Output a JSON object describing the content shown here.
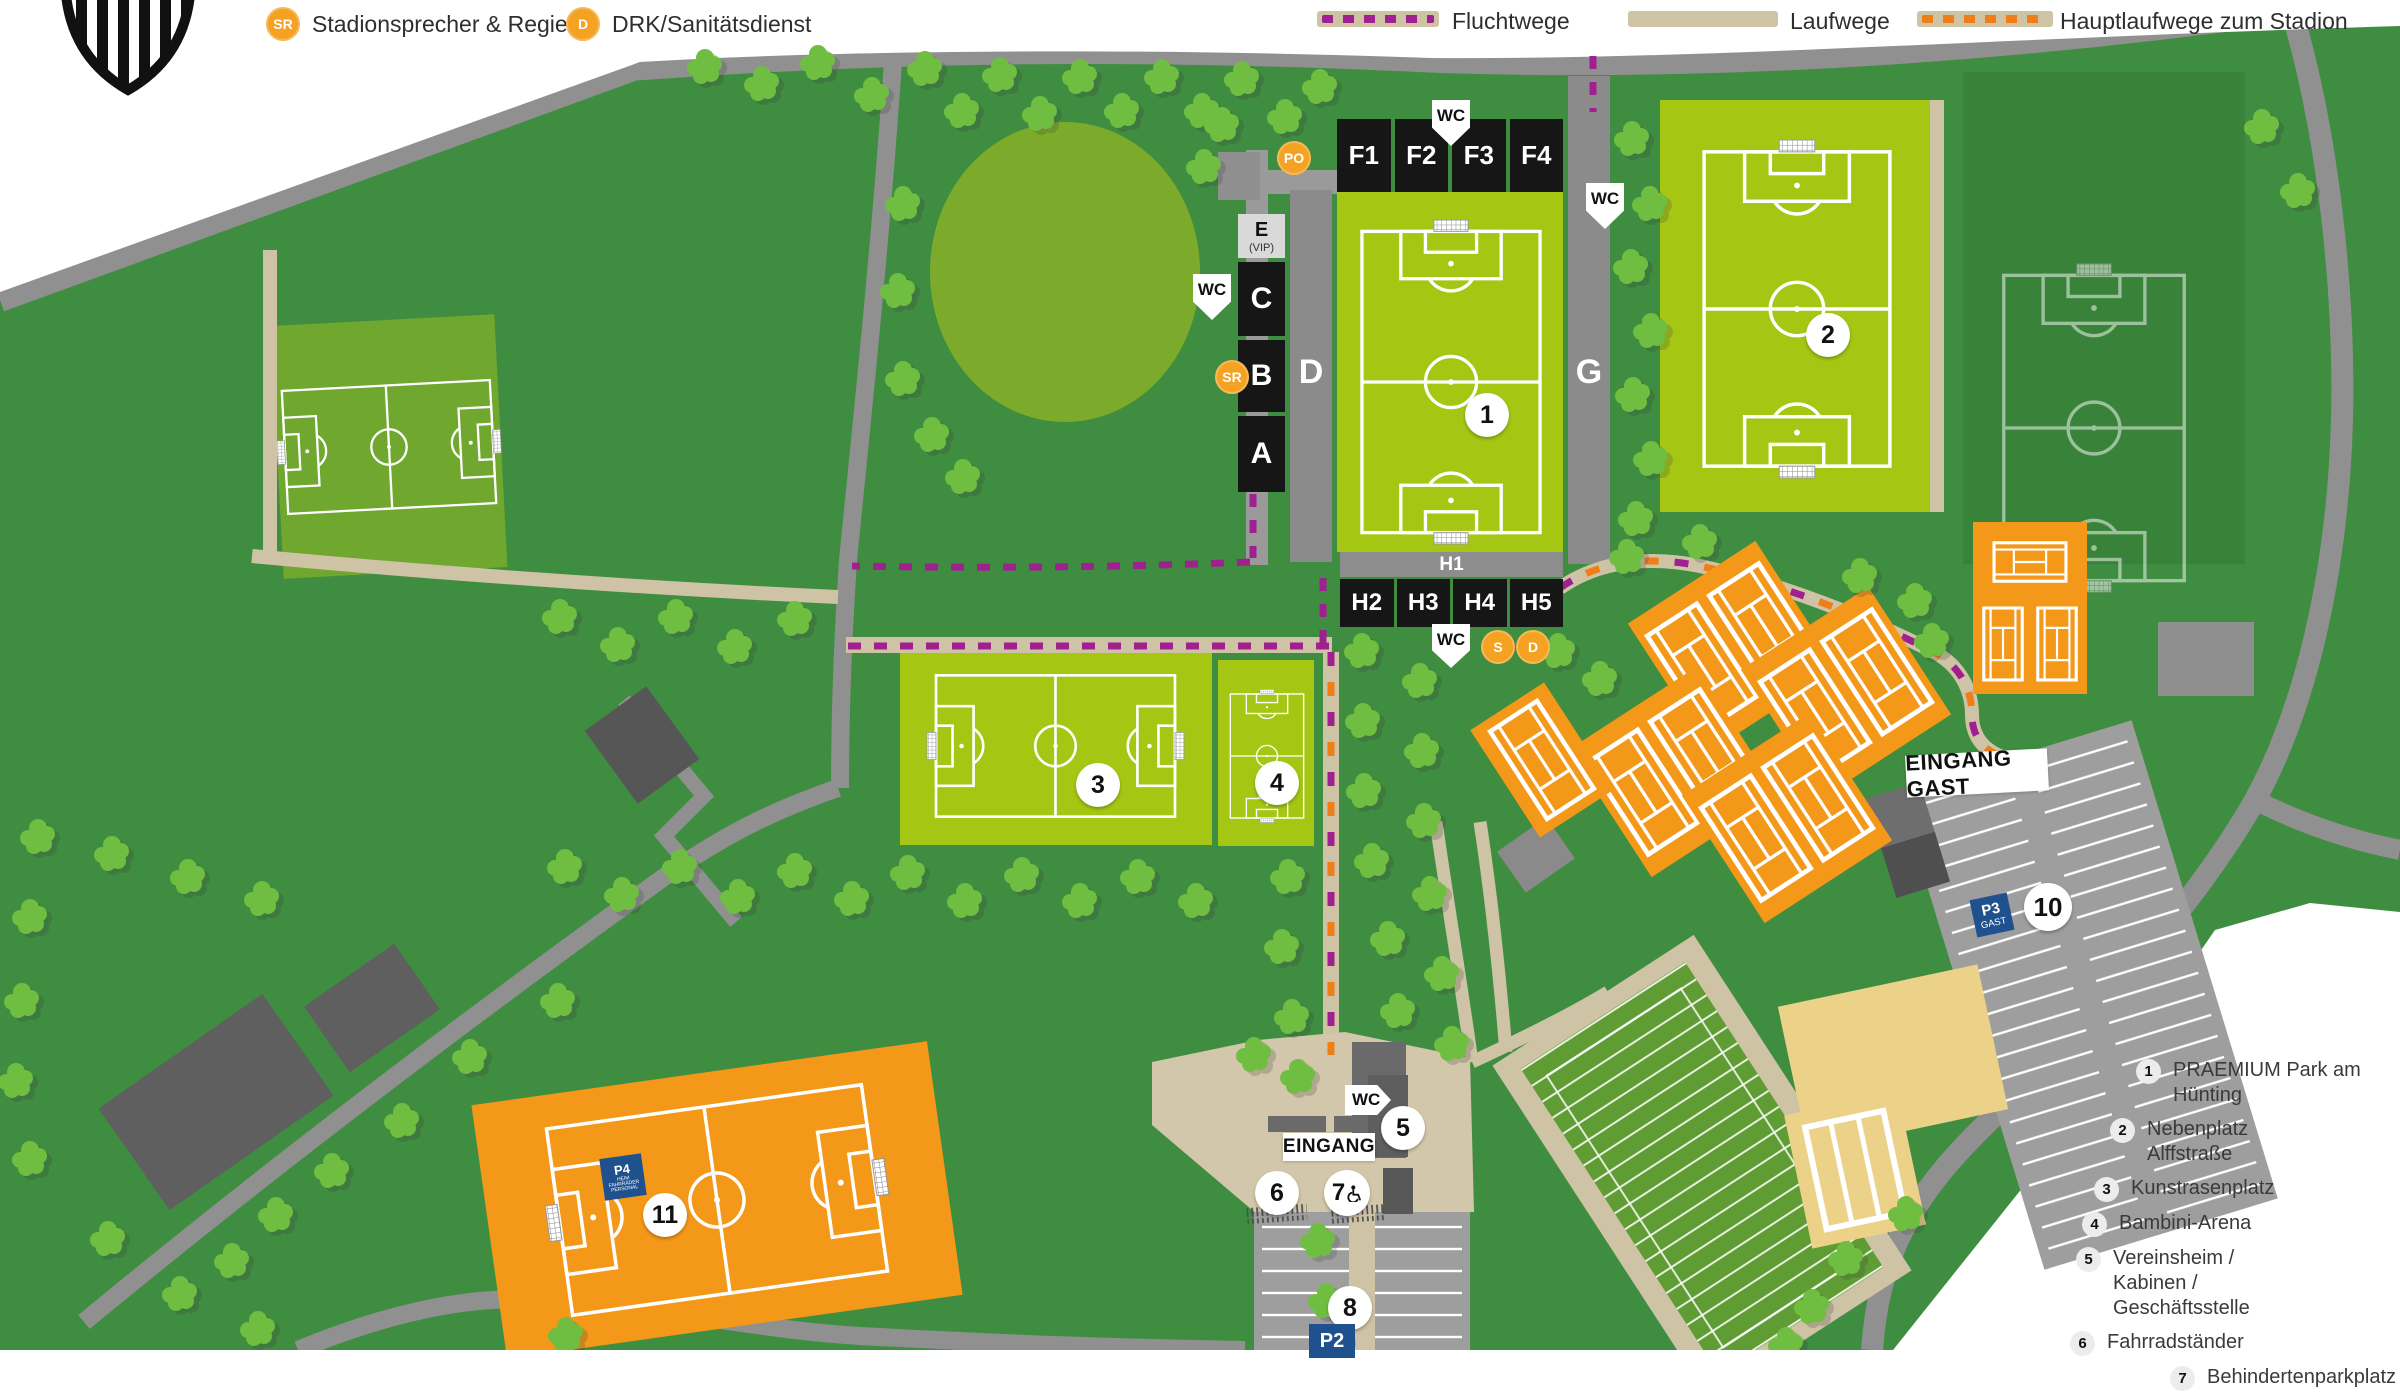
{
  "legend": {
    "sr": {
      "symbol": "SR",
      "label": "Stadionsprecher & Regie"
    },
    "drk": {
      "symbol": "D",
      "label": "DRK/Sanitätsdienst"
    },
    "flucht": {
      "label": "Fluchtwege"
    },
    "lauf": {
      "label": "Laufwege"
    },
    "haupt": {
      "label": "Hauptlaufwege zum Stadion"
    }
  },
  "stadium": {
    "north_blocks": [
      "F1",
      "F2",
      "F3",
      "F4"
    ],
    "vip": {
      "label": "E",
      "sub": "(VIP)"
    },
    "west_blocks": [
      "C",
      "B",
      "A"
    ],
    "west_walkway": "D",
    "east_walkway": "G",
    "south_bar": "H1",
    "south_blocks": [
      "H2",
      "H3",
      "H4",
      "H5"
    ]
  },
  "badges": {
    "wc": "WC",
    "po": "PO",
    "sr": "SR",
    "s": "S",
    "d": "D"
  },
  "markers": {
    "n1": "1",
    "n2": "2",
    "n3": "3",
    "n4": "4",
    "n5": "5",
    "n6": "6",
    "n7": "7",
    "n8": "8",
    "n10": "10",
    "n11": "11"
  },
  "entrances": {
    "main": "EINGANG",
    "guest": "EINGANG GAST"
  },
  "parking": {
    "p2": "P2",
    "p3": {
      "line1": "P3",
      "line2": "GAST"
    },
    "p4": {
      "line1": "P4",
      "sub1": "HEIM",
      "sub2": "FAHRRÄDER",
      "sub3": "PERSONAL"
    }
  },
  "locations": [
    {
      "num": "1",
      "label": "PRAEMIUM Park am Hünting"
    },
    {
      "num": "2",
      "label": "Nebenplatz Alffstraße"
    },
    {
      "num": "3",
      "label": "Kunstrasenplatz"
    },
    {
      "num": "4",
      "label": "Bambini-Arena"
    },
    {
      "num": "5",
      "label": "Vereinsheim / Kabinen / Geschäftsstelle"
    },
    {
      "num": "6",
      "label": "Fahrradständer"
    },
    {
      "num": "7",
      "label": "Behindertenparkplatz"
    }
  ],
  "colors": {
    "base_green": "#3f8d40",
    "pitch_bright": "#a6c614",
    "orange": "#f49819",
    "flucht_purple": "#a0208f",
    "haupt_orange": "#ef7d18",
    "path_beige": "#cfc3a6",
    "parking_blue": "#20518f"
  }
}
